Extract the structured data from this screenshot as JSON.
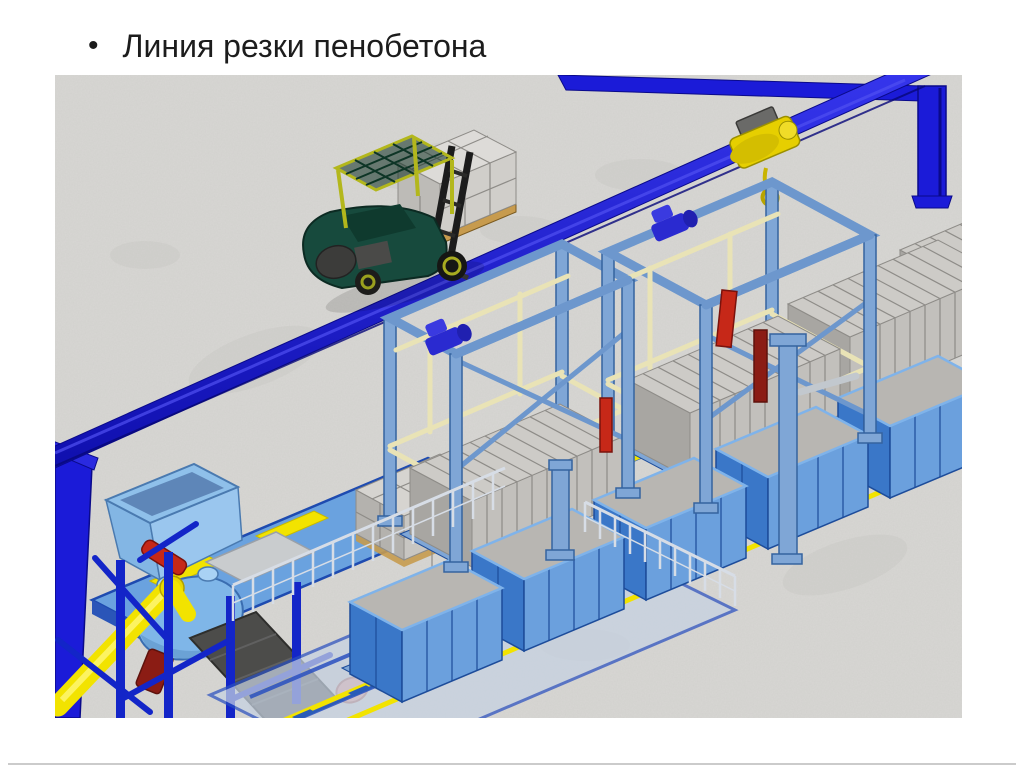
{
  "slide": {
    "bullet": "•",
    "title": "Линия резки пенобетона"
  },
  "palette": {
    "bg": "#ffffff",
    "title": "#1c1c1c",
    "footline": "#cbcbcb",
    "floor": "#d8d7d4",
    "beam": "#1b1bd8",
    "beamDark": "#0a0a8a",
    "beamLite": "#5050f2",
    "frameBlue": "#1325c8",
    "steel": "#6d97cd",
    "steelFill": "#7fa6d6",
    "steelDark": "#35639f",
    "cream": "#e9e3b6",
    "creamDark": "#b7ae7c",
    "royal": "#2a2ad0",
    "moldFrontL": "#3a77c8",
    "moldFrontR": "#6ba0dd",
    "moldDark": "#1d4c9a",
    "moldRim": "#2a5cb8",
    "blockFront": "#a8a6a2",
    "blockSide": "#c2c0bc",
    "blockTop": "#cdcbc7",
    "blockLine": "#8e8c88",
    "yellow": "#f2e300",
    "yellowDark": "#c7b900",
    "hoistYellow": "#e6cf00",
    "forkGreen": "#174a3d",
    "forkGreenDark": "#0c2a22",
    "cageYellow": "#b3b71c",
    "red": "#c62818",
    "maroon": "#8b1c14",
    "pink": "#e89a92",
    "conveyor": "#4c4c4a",
    "deck": "#6aa2df",
    "hopper": "#8fc0ea",
    "drum": "#7fb6e8",
    "fence": "#c6d2e2",
    "railing": "#d7dde6"
  },
  "scene": {
    "components": [
      {
        "name": "concrete-floor",
        "color": "#d8d7d4"
      },
      {
        "name": "crane-runway-beam",
        "color": "#1b1bd8"
      },
      {
        "name": "crane-runway-far-beam",
        "color": "#1b1bd8"
      },
      {
        "name": "crane-column-right",
        "color": "#1b1bd8"
      },
      {
        "name": "crane-column-left",
        "color": "#1b1bd8"
      },
      {
        "name": "crane-hoist-with-hook",
        "color": "#e6cf00"
      },
      {
        "name": "forklift-with-pallet-of-blocks",
        "color": "#174a3d"
      },
      {
        "name": "cutting-gantry-1",
        "color": "#6d97cd"
      },
      {
        "name": "cutting-gantry-2",
        "color": "#6d97cd"
      },
      {
        "name": "foam-concrete-cake-on-cart",
        "color": "#c2c0bc"
      },
      {
        "name": "mold-with-gray-top",
        "color": "#3a77c8"
      },
      {
        "name": "mold-line-rails",
        "color": "#f2e300"
      },
      {
        "name": "cake-line-rails",
        "color": "#f2e300"
      },
      {
        "name": "mixing-station-platform",
        "color": "#6aa2df"
      },
      {
        "name": "feed-hopper",
        "color": "#8fc0ea"
      },
      {
        "name": "mixer-drum",
        "color": "#7fb6e8"
      },
      {
        "name": "screw-conveyor-auger",
        "color": "#f2e300"
      },
      {
        "name": "belt-conveyor",
        "color": "#4c4c4a"
      },
      {
        "name": "drive-motor-pink",
        "color": "#e89a92"
      },
      {
        "name": "cut-block-stack",
        "color": "#d6d4d0"
      },
      {
        "name": "safety-railing",
        "color": "#d7dde6"
      },
      {
        "name": "fenced-curing-area",
        "color": "#c6d2e2"
      },
      {
        "name": "tilting-column",
        "color": "#7fa6d6"
      }
    ]
  }
}
